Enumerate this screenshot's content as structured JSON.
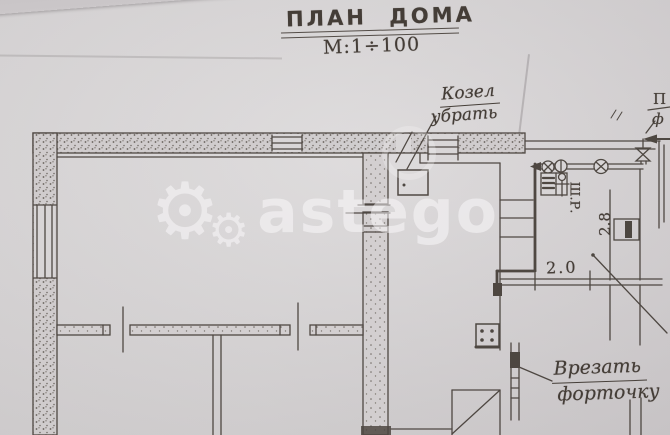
{
  "meta": {
    "description": "Photographed hand-drawn house floor plan",
    "paper_color": "#d6d3d4",
    "ink_color": "#443d37",
    "watermark_color": "rgba(252,250,251,0.52)"
  },
  "header": {
    "title": "ПЛАН ДОМА",
    "scale": "М:1÷100"
  },
  "watermark": {
    "gear_glyph": "⚙",
    "text": "astego"
  },
  "annotations": {
    "remove_flue_line1": "Козел",
    "remove_flue_line2": "убрать",
    "cut_vent_line1": "Врезать",
    "cut_vent_line2": "форточку"
  },
  "labels": {
    "regulator": "Ш.Р.",
    "dim_height": "2.8",
    "dim_width": "2.0",
    "edge_fragment_top": "П",
    "edge_fragment_bottom": "ф"
  }
}
